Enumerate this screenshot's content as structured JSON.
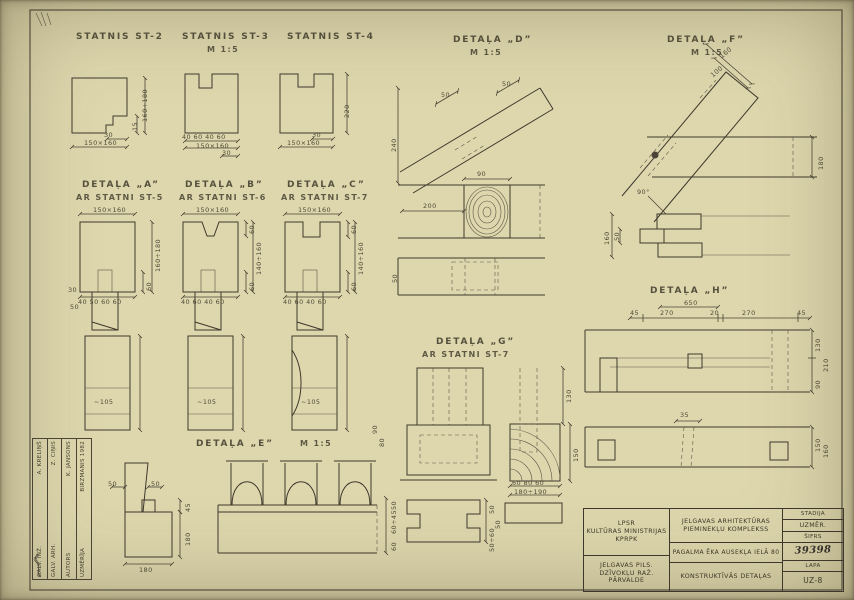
{
  "labels": {
    "st2": {
      "title": "STATNIS ST-2",
      "w": "150×160",
      "notch": "30",
      "h": "160÷180",
      "t": "15"
    },
    "st3": {
      "title": "STATNIS ST-3",
      "scale": "M 1:5",
      "top": "40 60 40 60",
      "w": "150×160",
      "notch": "30"
    },
    "st4": {
      "title": "STATNIS ST-4",
      "w": "150×160",
      "notch": "30",
      "h": "220"
    },
    "a": {
      "title": "DETAĻA „A”",
      "sub": "AR STATNI ST-5",
      "top": "150×160",
      "h": "160÷180",
      "t": "60",
      "bottom": "40 50 60 60",
      "l1": "30",
      "l2": "50"
    },
    "b": {
      "title": "DETAĻA „B”",
      "sub": "AR STATNI ST-6",
      "top": "150×160",
      "h": "140÷160",
      "t1": "60",
      "t2": "60",
      "bottom": "40 60 40 60"
    },
    "c": {
      "title": "DETAĻA „C”",
      "sub": "AR STATNI ST-7",
      "top": "150×160",
      "h": "140÷160",
      "t1": "60",
      "t2": "60",
      "bottom": "40 60 40 60"
    },
    "posts": {
      "p1": "~105",
      "p2": "~105",
      "p3": "~105"
    },
    "d": {
      "title": "DETAĻA „D”",
      "scale": "M 1:5",
      "s50a": "50",
      "s50b": "50",
      "v240": "240",
      "w90": "90",
      "w200": "200",
      "v50": "50"
    },
    "f": {
      "title": "DETAĻA „F”",
      "scale": "M 1:5",
      "d160": "160",
      "d100": "100",
      "v180": "180",
      "angle": "90°",
      "j160": "160",
      "j50": "50"
    },
    "h": {
      "title": "DETAĻA „H”",
      "total": "650",
      "s1": "45",
      "s2": "270",
      "s3": "20",
      "s4": "270",
      "s5": "45",
      "r1": "130",
      "r2": "210",
      "r3": "90",
      "mid": "35",
      "r4": "150",
      "r5": "160"
    },
    "g": {
      "title": "DETAĻA „G”",
      "sub": "AR STATNI ST-7",
      "v130": "130",
      "v150": "150",
      "b1": "60 80 60",
      "b2": "180÷190",
      "s1": "50",
      "s2": "50",
      "s3": "50÷60",
      "l1": "90",
      "l2": "80"
    },
    "e": {
      "title": "DETAĻA „E”",
      "scale": "M 1:5",
      "p1": "50",
      "p2": "50",
      "t45": "45",
      "v180": "180",
      "b180": "180",
      "r1": "50",
      "r2": "60÷45",
      "r3": "60"
    }
  },
  "titleblock": {
    "org_top": [
      "LPSR",
      "KULTŪRAS MINISTRIJAS",
      "KPRPK"
    ],
    "org_bottom": [
      "JELGAVAS PILS.",
      "DZĪVOKĻU RAŽ. PĀRVALDE"
    ],
    "project": [
      "JELGAVAS ARHITEKTŪRAS",
      "PIEMINEKĻU KOMPLEKSS"
    ],
    "object": "PAGALMA ĒKA AUSEKĻA IELĀ 80",
    "content": "KONSTRUKTĪVĀS DETAĻAS",
    "stadija_label": "STADIJA",
    "uzmer_label": "UZMĒR.",
    "sifrs_label": "ŠIFRS",
    "number": "39398",
    "lapa_label": "LAPA",
    "sheet_code": "UZ-8"
  },
  "signatures": {
    "rows": [
      {
        "label": "GALV. INŽ.",
        "name": "A. KRELIŅŠ"
      },
      {
        "label": "GALV. ARH.",
        "name": "Z. CIŅIS"
      },
      {
        "label": "AUTORS",
        "name": "K. JANSONS"
      },
      {
        "label": "UZMĒRĪJA",
        "name": "BIRZMANIS 1982"
      }
    ]
  }
}
